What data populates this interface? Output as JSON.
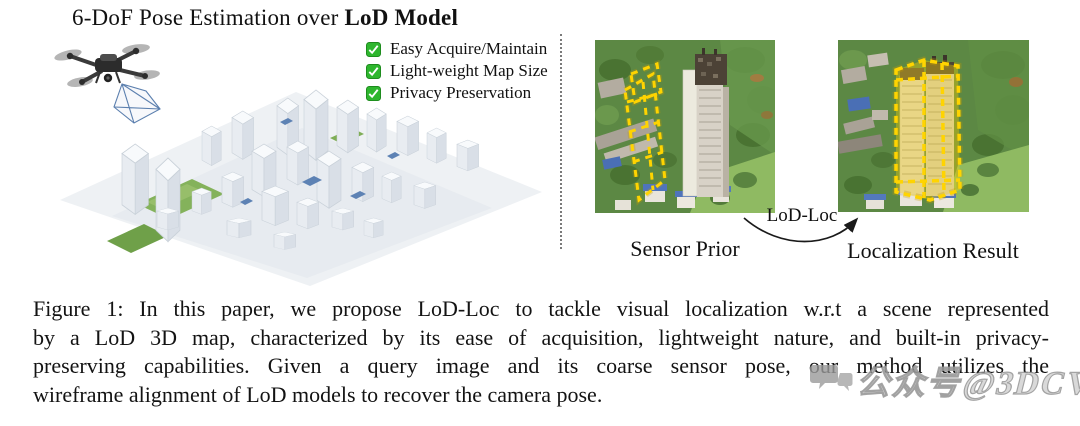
{
  "figure": {
    "title": {
      "regular": "6-DoF Pose Estimation over ",
      "bold": "LoD Model"
    },
    "checklist": [
      {
        "label": "Easy Acquire/Maintain"
      },
      {
        "label": "Light-weight Map Size"
      },
      {
        "label": "Privacy Preservation"
      }
    ],
    "panels": {
      "left_label": "Sensor Prior",
      "right_label": "Localization Result",
      "arrow_label": "LoD-Loc"
    },
    "caption": {
      "lines": [
        "Figure 1: In this paper, we propose LoD-Loc to tackle visual localization w.r.t a scene represented",
        "by a LoD 3D map, characterized by its ease of acquisition, lightweight nature, and built-in privacy-",
        "preserving capabilities. Given a query image and its coarse sensor pose, our method utilizes the",
        "wireframe alignment of LoD models to recover the camera pose."
      ]
    },
    "watermark": {
      "text": "公众号@3DCV"
    },
    "colors": {
      "check_green": "#2eb62e",
      "wireframe_yellow": "#ffd400",
      "separator_gray": "#7a7a7a"
    }
  }
}
